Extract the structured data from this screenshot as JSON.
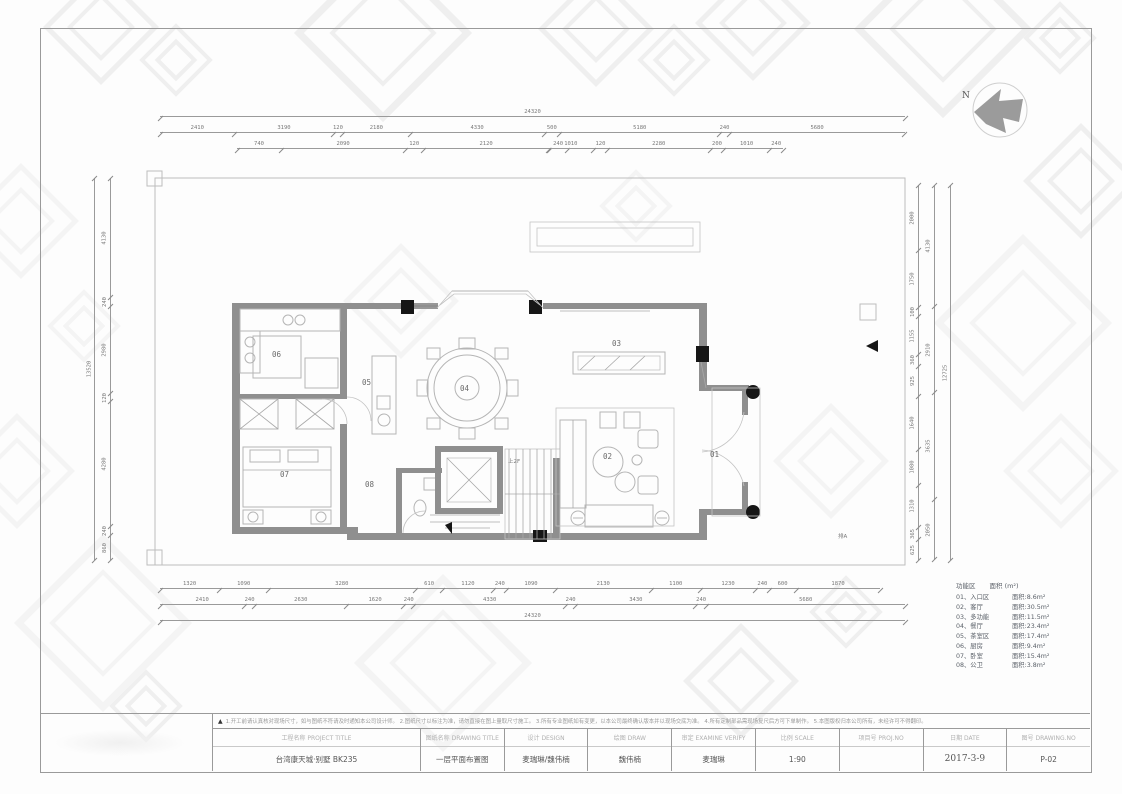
{
  "drawing": {
    "north_label": "N",
    "room_numbers": [
      "01",
      "02",
      "03",
      "04",
      "05",
      "06",
      "07",
      "08"
    ],
    "stair_note": "上2F",
    "drain_note": "排A"
  },
  "dimensions": {
    "top_overall": "24320",
    "top_row": [
      "2410",
      "3190",
      "120",
      "2180",
      "4330",
      "500",
      "5180",
      "240",
      "5680"
    ],
    "top_sub_left": [
      "740",
      "2090",
      "120",
      "2120",
      "240"
    ],
    "top_sub_right": [
      "1010",
      "120",
      "2280",
      "200",
      "1010",
      "240"
    ],
    "bottom_row1": [
      "1320",
      "1090",
      "3280",
      "610",
      "1120",
      "240",
      "1090",
      "2130",
      "1100",
      "1230",
      "240",
      "600",
      "1870"
    ],
    "bottom_row2": [
      "2410",
      "240",
      "2630",
      "1620",
      "240",
      "4330",
      "240",
      "3430",
      "240",
      "5680"
    ],
    "bottom_overall": "24320",
    "left_overall": "13520",
    "left_row": [
      "4130",
      "240",
      "2980",
      "120",
      "4280",
      "240",
      "860"
    ],
    "right_overall": "12725",
    "right_row": [
      "2000",
      "1750",
      "100",
      "1155",
      "360",
      "925",
      "1640",
      "1080",
      "1310",
      "365",
      "625"
    ],
    "right_row2": [
      "4130",
      "2910",
      "3635",
      "2050"
    ]
  },
  "legend": {
    "header_zone": "功能区",
    "header_area": "面积 (m²)",
    "rows": [
      {
        "name": "01、入口区",
        "area": "面积:8.6m²"
      },
      {
        "name": "02、客厅",
        "area": "面积:30.5m²"
      },
      {
        "name": "03、多功能",
        "area": "面积:11.5m²"
      },
      {
        "name": "04、餐厅",
        "area": "面积:23.4m²"
      },
      {
        "name": "05、茶室区",
        "area": "面积:17.4m²"
      },
      {
        "name": "06、厨房",
        "area": "面积:9.4m²"
      },
      {
        "name": "07、卧室",
        "area": "面积:15.4m²"
      },
      {
        "name": "08、公卫",
        "area": "面积:3.8m²"
      }
    ]
  },
  "titleblock": {
    "warn_symbol": "▲",
    "notes": "1.开工前请认真核对现场尺寸，如与图纸不符请及时通知本公司设计师。  2.图纸尺寸以标注为准，请勿直接在图上量取尺寸施工。  3.所有专业图纸如有变更，以本公司最终确认版本并以现场交底为准。  4.所有定制部品需现场复尺后方可下单制作。  5.本图版权归本公司所有，未经许可不得翻印。",
    "columns": [
      {
        "label": "工程名称 PROJECT TITLE",
        "value": "台湾康天城·别墅 BK235"
      },
      {
        "label": "图纸名称 DRAWING TITLE",
        "value": "一层平面布置图"
      },
      {
        "label": "设计 DESIGN",
        "value": "麦瑞琳/魏伟楠"
      },
      {
        "label": "绘图 DRAW",
        "value": "魏伟楠"
      },
      {
        "label": "审定 EXAMINE VERIFY",
        "value": "麦瑞琳"
      },
      {
        "label": "比例 SCALE",
        "value": "1:90"
      },
      {
        "label": "项目号 PROJ.NO",
        "value": ""
      },
      {
        "label": "日期 DATE",
        "value": "2017-3-9"
      },
      {
        "label": "图号 DRAWING.NO",
        "value": "P-02"
      }
    ]
  }
}
